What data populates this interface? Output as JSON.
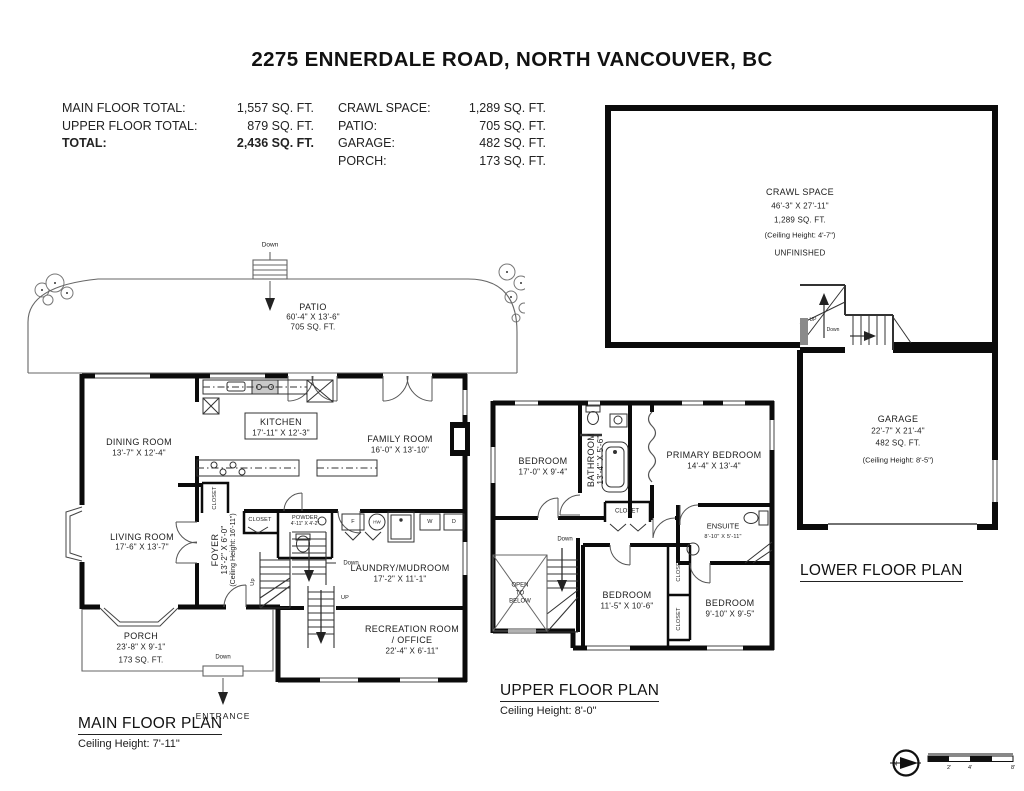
{
  "page_title": "2275 ENNERDALE ROAD, NORTH VANCOUVER, BC",
  "summary": {
    "left": [
      {
        "label": "MAIN FLOOR TOTAL:",
        "value": "1,557 SQ. FT."
      },
      {
        "label": "UPPER FLOOR TOTAL:",
        "value": "879 SQ. FT."
      },
      {
        "label": "TOTAL:",
        "value": "2,436 SQ. FT."
      }
    ],
    "right": [
      {
        "label": "CRAWL SPACE:",
        "value": "1,289 SQ. FT."
      },
      {
        "label": "PATIO:",
        "value": "705 SQ. FT."
      },
      {
        "label": "GARAGE:",
        "value": "482 SQ. FT."
      },
      {
        "label": "PORCH:",
        "value": "173 SQ. FT."
      }
    ]
  },
  "main_floor": {
    "plan_title": "MAIN FLOOR PLAN",
    "ceiling": "Ceiling Height: 7'-11\"",
    "patio": {
      "name": "PATIO",
      "dim": "60'-4\" X 13'-6\"",
      "area": "705 SQ. FT."
    },
    "dining": {
      "name": "DINING ROOM",
      "dim": "13'-7\" X 12'-4\""
    },
    "kitchen": {
      "name": "KITCHEN",
      "dim": "17'-11\" X 12'-3\""
    },
    "family": {
      "name": "FAMILY ROOM",
      "dim": "16'-0\" X 13'-10\""
    },
    "living": {
      "name": "LIVING ROOM",
      "dim": "17'-6\" X 13'-7\""
    },
    "foyer": {
      "name": "FOYER",
      "dim": "13'-2\" X 6'-0\"",
      "ceiling": "(Ceiling Height: 16'-11\")"
    },
    "powder": {
      "name": "POWDER",
      "dim": "4'-11\" X 4'-2\""
    },
    "laundry": {
      "name": "LAUNDRY/MUDROOM",
      "dim": "17'-2\" X 11'-1\""
    },
    "recreation": {
      "name": "RECREATION ROOM",
      "name2": "/ OFFICE",
      "dim": "22'-4\" X 6'-11\""
    },
    "porch": {
      "name": "PORCH",
      "dim": "23'-8\" X 9'-1\"",
      "area": "173 SQ. FT."
    },
    "closet1": "CLOSET",
    "closet2": "CLOSET",
    "entrance": "ENTRANCE",
    "down_patio": "Down",
    "down_entrance": "Down",
    "down_stairs": "Down",
    "up_stairs": "Up",
    "up_rec": "UP",
    "appliances": {
      "f": "F",
      "hw": "HW",
      "w": "W",
      "d": "D"
    }
  },
  "upper_floor": {
    "plan_title": "UPPER FLOOR PLAN",
    "ceiling": "Ceiling Height: 8'-0\"",
    "bedroom1": {
      "name": "BEDROOM",
      "dim": "17'-0\" X 9'-4\""
    },
    "bathroom": {
      "name": "BATHROOM",
      "dim": "13'-4\" X 5'-6\""
    },
    "primary": {
      "name": "PRIMARY BEDROOM",
      "dim": "14'-4\" X 13'-4\""
    },
    "ensuite": {
      "name": "ENSUITE",
      "dim": "8'-10\" X 5'-11\""
    },
    "closet_hall": "CLOSET",
    "closet_a": "CLOSET",
    "closet_b": "CLOSET",
    "open_below": {
      "l1": "OPEN",
      "l2": "TO",
      "l3": "BELOW"
    },
    "bedroom2": {
      "name": "BEDROOM",
      "dim": "11'-5\" X 10'-6\""
    },
    "bedroom3": {
      "name": "BEDROOM",
      "dim": "9'-10\" X 9'-5\""
    },
    "down": "Down"
  },
  "lower_floor": {
    "plan_title": "LOWER FLOOR PLAN",
    "crawl": {
      "name": "CRAWL SPACE",
      "dim": "46'-3\" X 27'-11\"",
      "area": "1,289 SQ. FT.",
      "ceiling": "(Ceiling Height: 4'-7\")",
      "status": "UNFINISHED"
    },
    "garage": {
      "name": "GARAGE",
      "dim": "22'-7\" X 21'-4\"",
      "area": "482 SQ. FT.",
      "ceiling": "(Ceiling Height: 8'-5\")"
    },
    "up": "UP",
    "down": "Down"
  },
  "compass": {
    "n": "N"
  },
  "scale_bar": {
    "t1": "2'",
    "t2": "4'",
    "t3": "8'"
  }
}
